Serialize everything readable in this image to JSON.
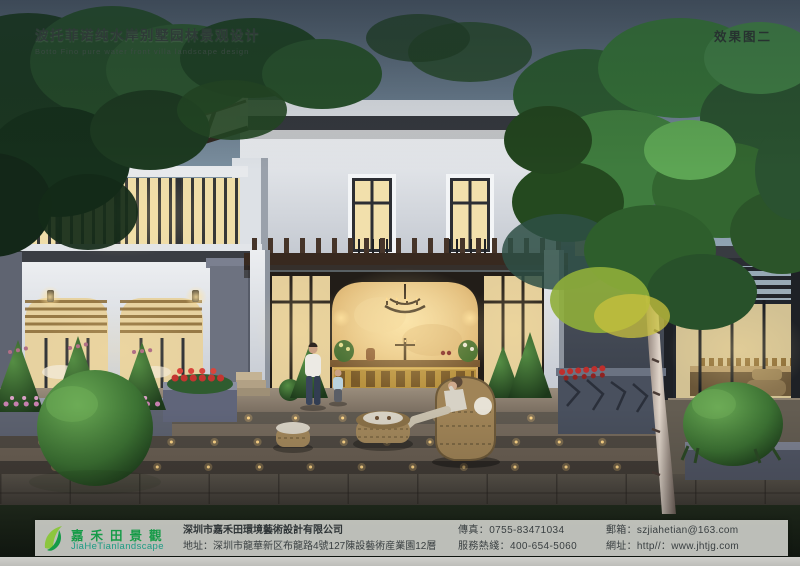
{
  "board": {
    "title": "波托菲诺纯水岸别墅园林景观设计",
    "subtitle": "Botto Fino pure water front villa landscape design",
    "view_label": "效果图二"
  },
  "footer": {
    "logo_icon": "leaf-swoosh-icon",
    "logo_cn": "嘉禾田景觀",
    "logo_en": "JiaHeTianlandscape",
    "company": "深圳市嘉禾田環境藝術設計有限公司",
    "address": "地址：深圳市龍華新区布龍路4號127陳設藝術産業園12層",
    "fax": "傳真：0755-83471034",
    "hotline": "服務熱綫：400-654-5060",
    "email": "郵箱：szjiahetian@163.com",
    "website": "網址：http//：www.jhtjg.com"
  },
  "colors": {
    "logo_green": "#169b48",
    "logo_light_green": "#8cc63f",
    "logo_teal": "#1d9b84",
    "warm_light": "#f2dda6"
  }
}
